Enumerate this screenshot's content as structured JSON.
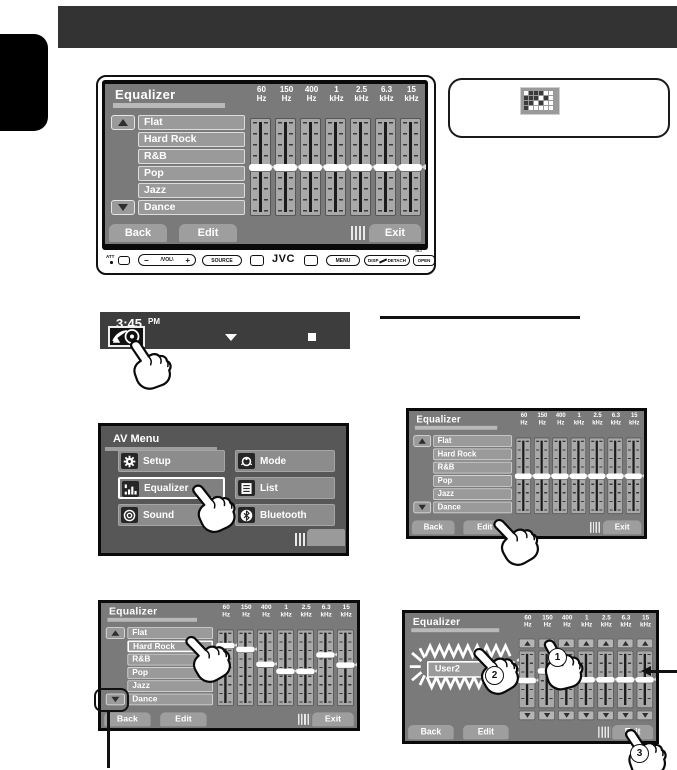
{
  "colors": {
    "header_bar": "#333333",
    "screen_bg": "#7a7a7a",
    "bezel": "#0a0a0a",
    "menu_bg": "#575757",
    "button_grey": "#9e9e9e",
    "accent_white": "#ffffff"
  },
  "eq_common": {
    "title": "Equalizer",
    "back": "Back",
    "edit": "Edit",
    "exit": "Exit"
  },
  "freq_labels": [
    {
      "value": "60",
      "unit": "Hz"
    },
    {
      "value": "150",
      "unit": "Hz"
    },
    {
      "value": "400",
      "unit": "Hz"
    },
    {
      "value": "1",
      "unit": "kHz"
    },
    {
      "value": "2.5",
      "unit": "kHz"
    },
    {
      "value": "6.3",
      "unit": "kHz"
    },
    {
      "value": "15",
      "unit": "kHz"
    }
  ],
  "presets": [
    "Flat",
    "Hard Rock",
    "R&B",
    "Pop",
    "Jazz",
    "Dance"
  ],
  "screens": {
    "top": {
      "selected": null,
      "sliders": [
        50,
        50,
        50,
        50,
        50,
        50,
        50
      ]
    },
    "mid_right": {
      "selected": null,
      "sliders": [
        50,
        50,
        50,
        50,
        50,
        50,
        50
      ]
    },
    "bottom_left": {
      "selected": "Hard Rock",
      "sliders": [
        16,
        22,
        45,
        55,
        55,
        30,
        46
      ]
    },
    "bottom_right": {
      "edit": true,
      "user_preset": "User2",
      "sliders": [
        52,
        33,
        50,
        50,
        50,
        50,
        50
      ]
    }
  },
  "steps": [
    "1",
    "2",
    "3"
  ],
  "clock": {
    "time": "3:45",
    "ampm": "PM"
  },
  "av_menu": {
    "title": "AV Menu",
    "highlighted": "Equalizer",
    "items": [
      {
        "label": "Setup",
        "icon": "gear-icon"
      },
      {
        "label": "Mode",
        "icon": "mode-dial-icon"
      },
      {
        "label": "Equalizer",
        "icon": "equalizer-icon"
      },
      {
        "label": "List",
        "icon": "list-icon"
      },
      {
        "label": "Sound",
        "icon": "sound-icon"
      },
      {
        "label": "Bluetooth",
        "icon": "bluetooth-icon"
      }
    ]
  },
  "control_panel": {
    "att": "ATT",
    "vol": {
      "minus": "−",
      "label": "/VOL\\",
      "plus": "+"
    },
    "source": "SOURCE",
    "brand": "JVC",
    "menu": "MENU",
    "disp": "DISP",
    "detach": "DETACH",
    "open": "OPEN",
    "tilt": "TILT"
  }
}
